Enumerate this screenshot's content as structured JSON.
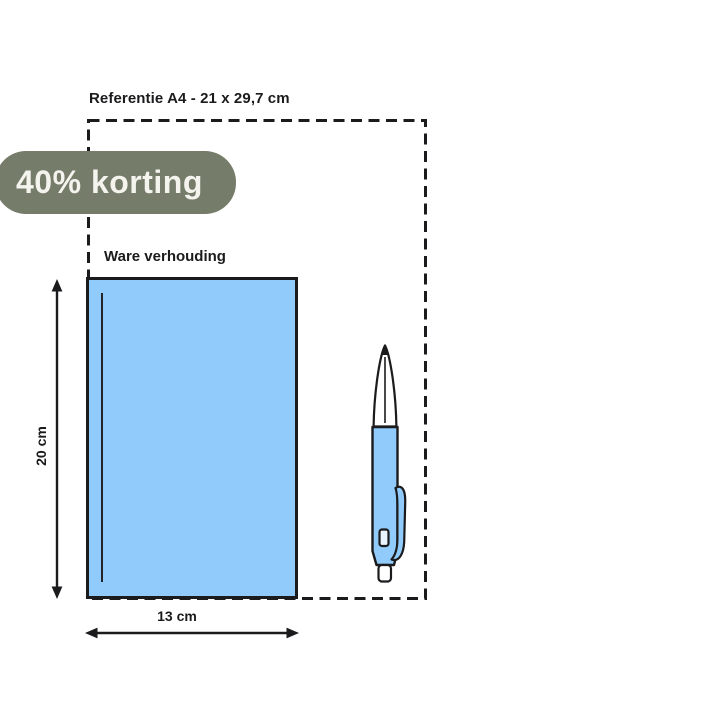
{
  "badge": {
    "label": "40% korting",
    "background_color": "#767c6a",
    "text_color": "#f4f3ee"
  },
  "reference_box": {
    "label": "Referentie A4 - 21 x 29,7 cm",
    "stroke_color": "#1b1b1d"
  },
  "product": {
    "scale_label": "Ware verhouding",
    "height_label": "20 cm",
    "width_label": "13 cm",
    "fill_color": "#90cbfb",
    "outline_color": "#1b1b1d"
  },
  "pen": {
    "body_color": "#90cbfb",
    "outline_color": "#1b1b1d"
  }
}
